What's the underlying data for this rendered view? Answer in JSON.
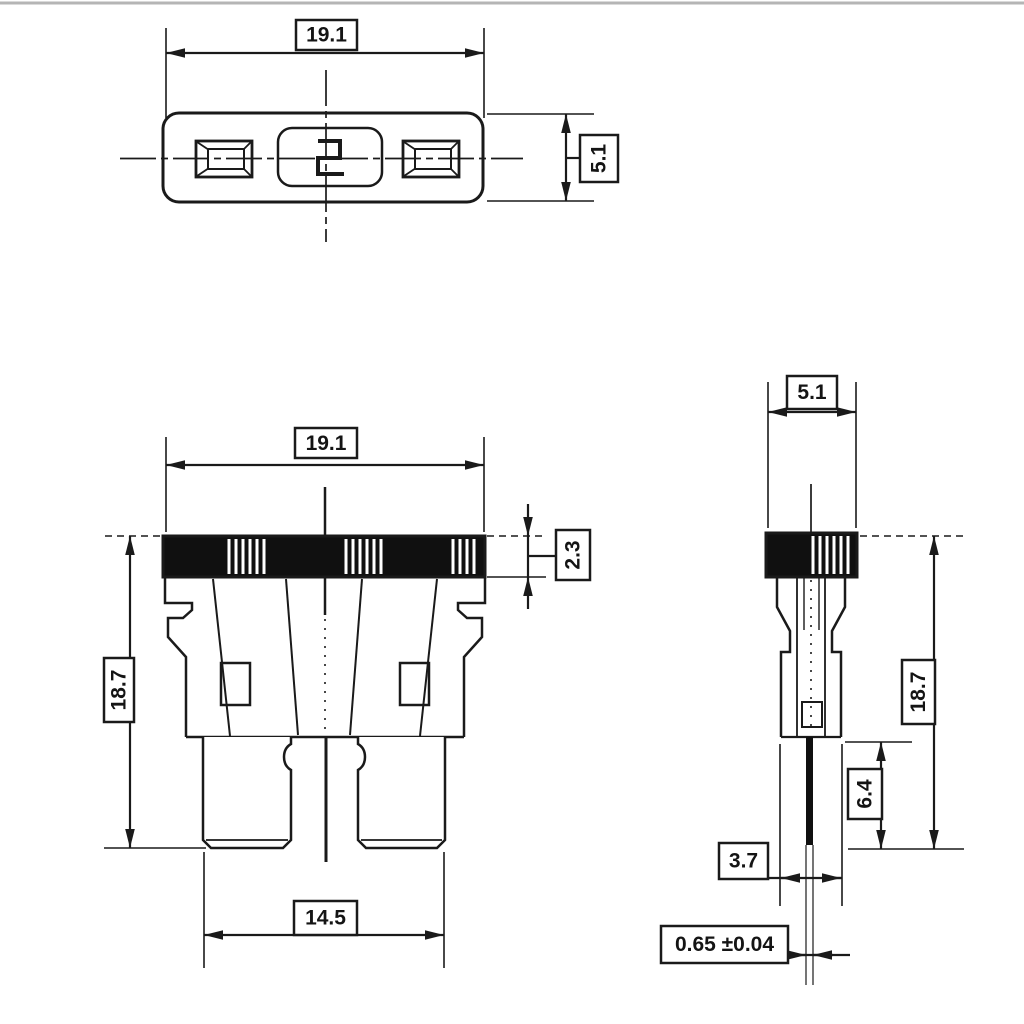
{
  "page": {
    "background": "#ffffff",
    "line_color": "#1a1a1a",
    "scan_border_color": "#b5b5b5"
  },
  "dimensions": {
    "top_view": {
      "width": "19.1",
      "height": "5.1"
    },
    "front_view": {
      "width": "19.1",
      "overall_height": "18.7",
      "cap_height": "2.3",
      "blade_span": "14.5"
    },
    "side_view": {
      "width": "5.1",
      "overall_height": "18.7",
      "blade_length": "6.4",
      "lower_body_width": "3.7",
      "blade_thickness": "0.65 ±0.04"
    }
  }
}
